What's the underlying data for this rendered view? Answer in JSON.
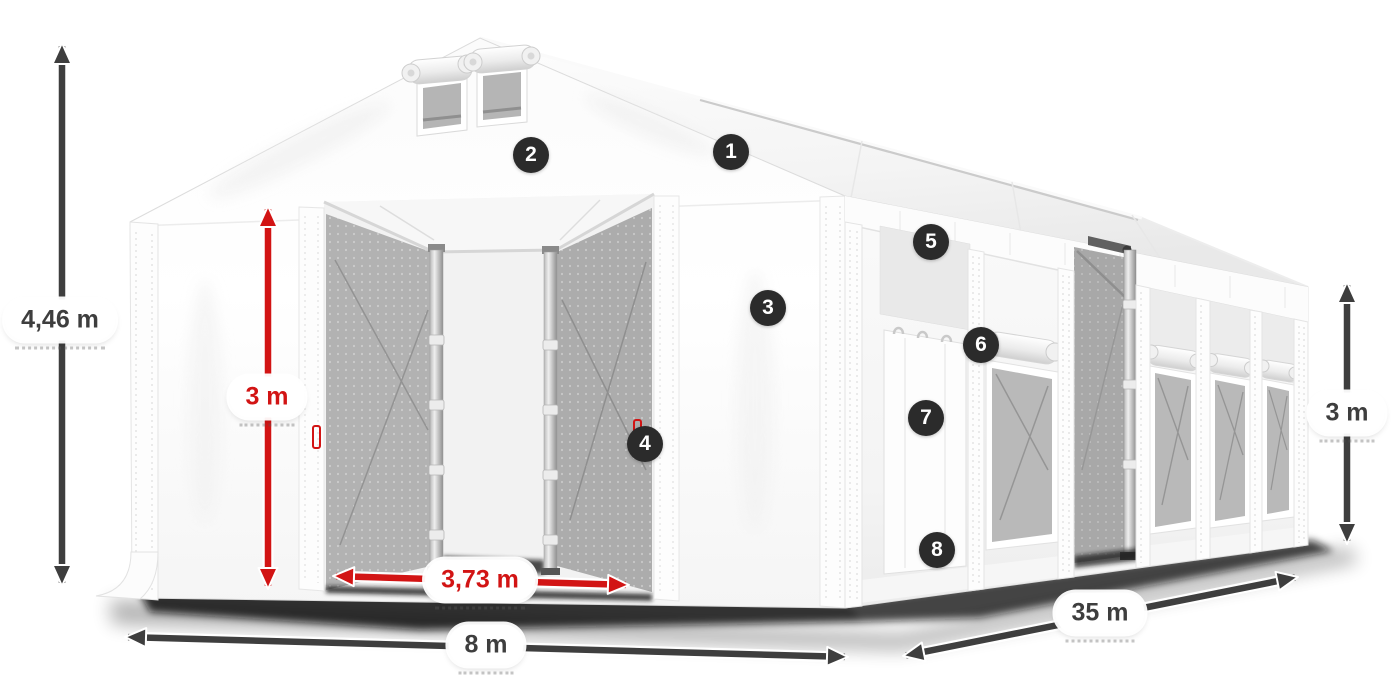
{
  "colors": {
    "accent_red": "#d21414",
    "dimension_dark": "#3e3e3e",
    "badge_background": "#2b2b2b",
    "badge_text": "#ffffff",
    "background": "#ffffff"
  },
  "dimensions": {
    "total_height": "4,46 m",
    "entrance_height": "3 m",
    "entrance_width": "3,73 m",
    "width": "8 m",
    "length": "35 m",
    "side_height": "3 m"
  },
  "callouts": [
    {
      "label": "1",
      "x": 731,
      "y": 152
    },
    {
      "label": "2",
      "x": 531,
      "y": 155
    },
    {
      "label": "3",
      "x": 768,
      "y": 308
    },
    {
      "label": "4",
      "x": 645,
      "y": 444
    },
    {
      "label": "5",
      "x": 931,
      "y": 242
    },
    {
      "label": "6",
      "x": 981,
      "y": 345
    },
    {
      "label": "7",
      "x": 926,
      "y": 418
    },
    {
      "label": "8",
      "x": 937,
      "y": 550
    }
  ]
}
